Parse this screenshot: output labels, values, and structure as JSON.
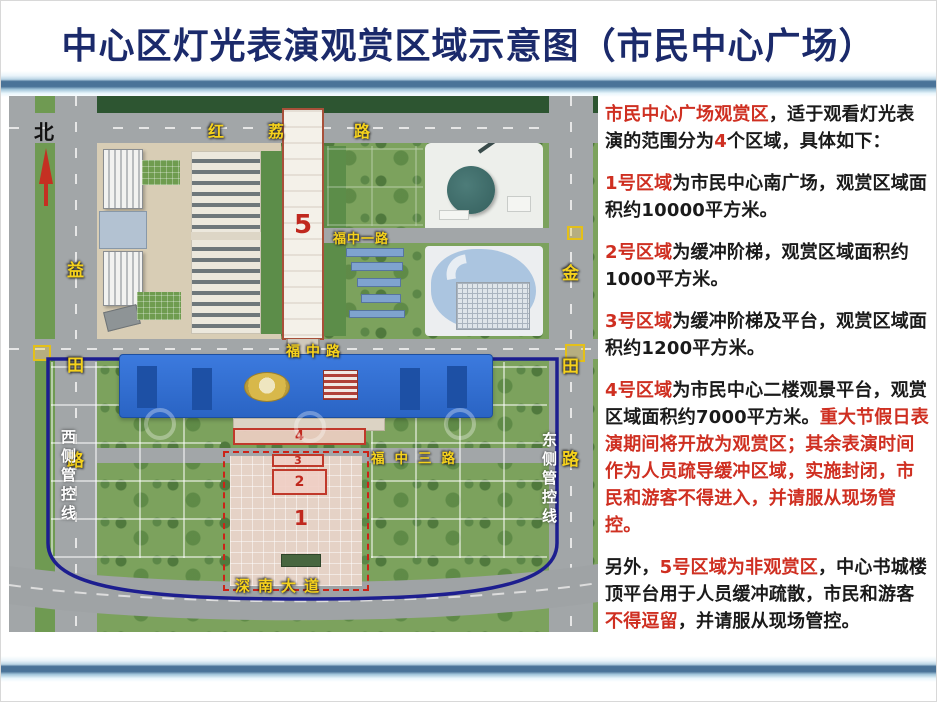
{
  "page": {
    "title": "中心区灯光表演观赏区域示意图（市民中心广场）"
  },
  "colors": {
    "title_blue": "#1b2a6b",
    "accent_red": "#cf2f21",
    "road_label_yellow": "#f6d21c",
    "perimeter_navy": "#1d1e8f",
    "zone_marker_red": "#c0392b",
    "civic_center_blue": "#2f6fd2",
    "divider_steel_blue": "#4a7398"
  },
  "map": {
    "north_label": "北",
    "roads": {
      "hongli": {
        "name": "红荔路",
        "chars": [
          "红",
          "荔",
          "路"
        ]
      },
      "yitian": {
        "name": "益田路",
        "chars": [
          "益",
          "田",
          "路"
        ]
      },
      "jintian": {
        "name": "金田路",
        "chars": [
          "金",
          "田",
          "路"
        ]
      },
      "fuzhong1": {
        "name": "福中一路"
      },
      "fuzhong": {
        "name": "福中路"
      },
      "fuzhong3": {
        "name": "福中三路"
      },
      "shennan": {
        "name": "深南大道"
      }
    },
    "control_lines": {
      "west": "西侧管控线",
      "east": "东侧管控线"
    },
    "zones": {
      "z1": "1",
      "z2": "2",
      "z3": "3",
      "z4": "4",
      "z5": "5"
    }
  },
  "panel": {
    "paragraphs": [
      {
        "segments": [
          {
            "t": "市民中心广场观赏区",
            "c": "red"
          },
          {
            "t": "，适于观看灯光表演的范围分为",
            "c": "black"
          },
          {
            "t": "4",
            "c": "red"
          },
          {
            "t": "个区域，具体如下：",
            "c": "black"
          }
        ]
      },
      {
        "segments": [
          {
            "t": "1号区域",
            "c": "red"
          },
          {
            "t": "为市民中心南广场，观赏区域面积约10000平方米。",
            "c": "black"
          }
        ]
      },
      {
        "segments": [
          {
            "t": "2号区域",
            "c": "red"
          },
          {
            "t": "为缓冲阶梯，观赏区域面积约1000平方米。",
            "c": "black"
          }
        ]
      },
      {
        "segments": [
          {
            "t": "3号区域",
            "c": "red"
          },
          {
            "t": "为缓冲阶梯及平台，观赏区域面积约1200平方米。",
            "c": "black"
          }
        ]
      },
      {
        "segments": [
          {
            "t": "4号区域",
            "c": "red"
          },
          {
            "t": "为市民中心二楼观景平台，观赏区域面积约7000平方米。",
            "c": "black"
          },
          {
            "t": "重大节假日表演期间将开放为观赏区；其余表演时间作为人员疏导缓冲区域，实施封闭，市民和游客不得进入，并请服从现场管控。",
            "c": "red"
          }
        ]
      },
      {
        "segments": [
          {
            "t": "另外，",
            "c": "black"
          },
          {
            "t": "5号区域为非观赏区",
            "c": "red"
          },
          {
            "t": "，中心书城楼顶平台用于人员缓冲疏散，市民和游客",
            "c": "black"
          },
          {
            "t": "不得逗留",
            "c": "red"
          },
          {
            "t": "，并请服从现场管控。",
            "c": "black"
          }
        ]
      }
    ]
  }
}
